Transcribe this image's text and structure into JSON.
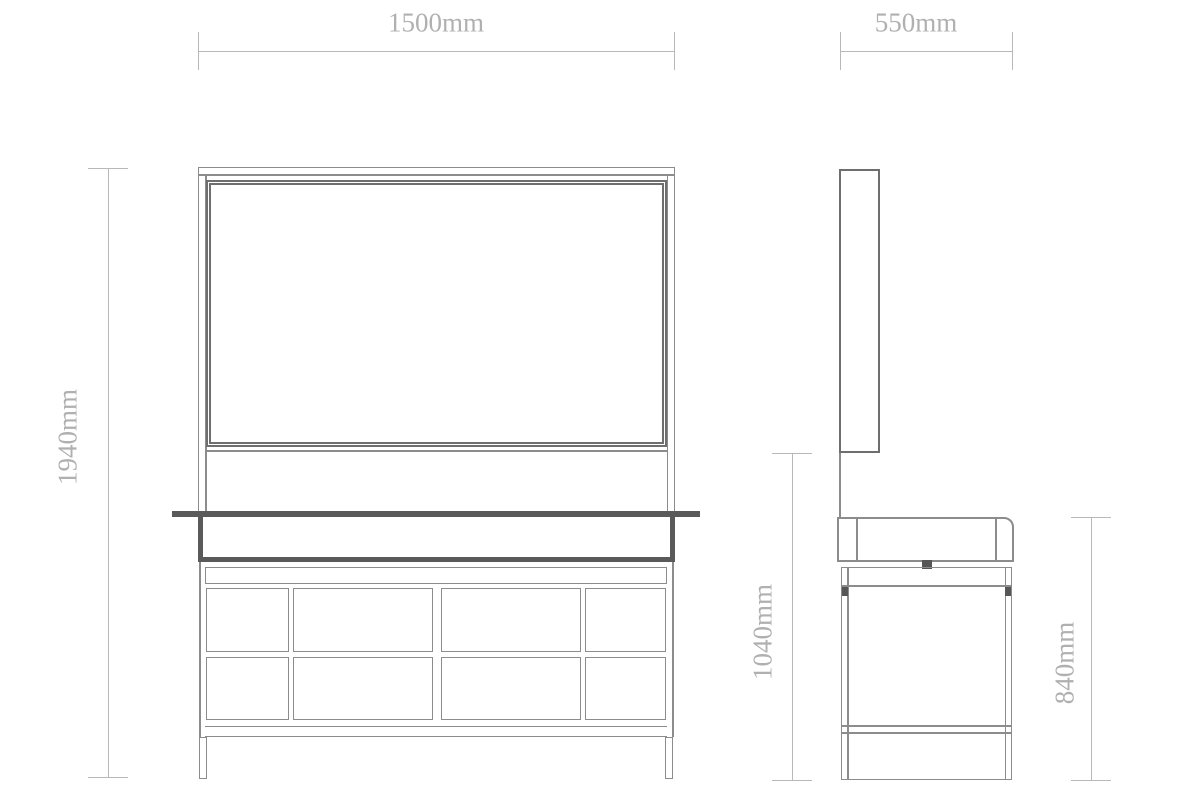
{
  "drawing": {
    "views": {
      "front": "front-view",
      "side": "side-view"
    },
    "dimensions": {
      "front_width": "1500mm",
      "front_height": "1940mm",
      "side_width": "550mm",
      "side_mirror_to_floor": "1040mm",
      "side_counter_height": "840mm"
    }
  },
  "colors": {
    "background": "#ffffff",
    "line": "#8c8c8c",
    "line-dark": "#6e6e6e",
    "heavy": "#5a5a5a",
    "accent-dark": "#565656",
    "dim-line": "#b8b8b8",
    "dim-text": "#b0b0b0"
  }
}
